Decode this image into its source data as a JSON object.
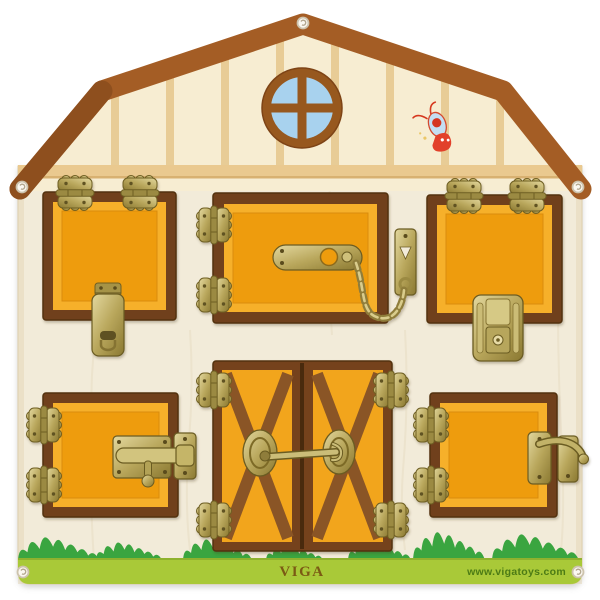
{
  "branding": {
    "logo_text": "VIGA",
    "website_text": "www.vigatoys.com"
  },
  "scene": {
    "subject": "barn-shaped wooden latches activity board",
    "decorations": [
      "round-window",
      "butterfly-decal",
      "grass-border"
    ],
    "doors": [
      {
        "id": "top-left",
        "latch": "hasp-latch",
        "hinge_side": "top"
      },
      {
        "id": "top-middle",
        "latch": "swivel-bar-chain-latch",
        "hinge_side": "left"
      },
      {
        "id": "top-right",
        "latch": "case-clasp-latch",
        "hinge_side": "top"
      },
      {
        "id": "bottom-left",
        "latch": "barrel-bolt-latch",
        "hinge_side": "left"
      },
      {
        "id": "bottom-middle",
        "latch": "cabin-hook-latch",
        "hinge_side": "outer-double"
      },
      {
        "id": "bottom-right",
        "latch": "gate-hook-latch",
        "hinge_side": "left"
      }
    ],
    "screw_count": 5
  },
  "colors": {
    "roof_brown": "#a45d25",
    "roof_brown_dark": "#8e4f1e",
    "wall_cream": "#f2ebd9",
    "gable_cream": "#f7edd2",
    "stripe_tan": "#e8cc96",
    "eave_band_tan": "#eac98f",
    "window_blue": "#a8d2ee",
    "window_brown": "#97581e",
    "door_frame_brown": "#6f411c",
    "door_orange": "#ee9c10",
    "door_orange_light": "#f6b02b",
    "brass": "#b3a256",
    "grass_green": "#3aa540",
    "baseboard_green": "#a9c938",
    "butterfly_red": "#d9402a",
    "butterfly_blue": "#c4def2",
    "logo_green_brown": "#7b5a14",
    "url_green": "#4c7b15"
  }
}
